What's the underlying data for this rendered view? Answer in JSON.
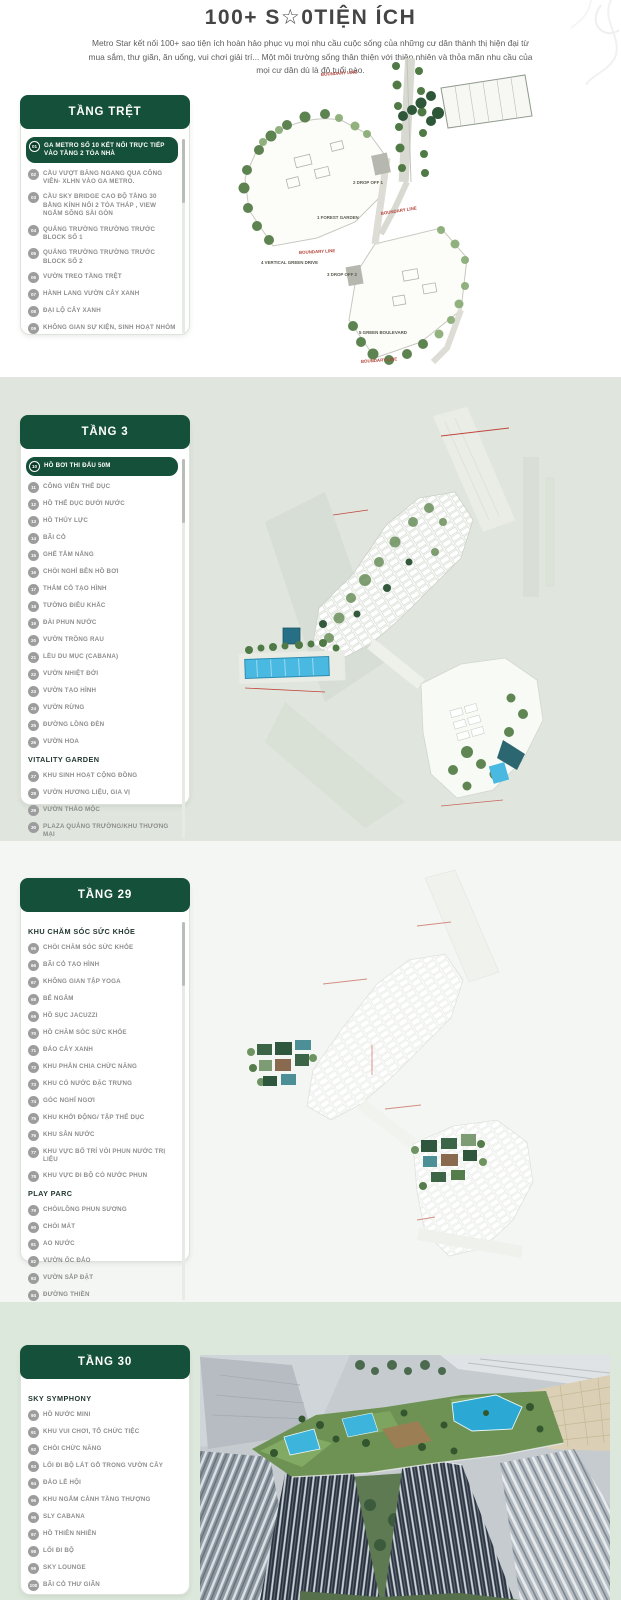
{
  "page": {
    "title": "100+ S☆0TIỆN ÍCH",
    "description": "Metro Star kết nối 100+ sao tiện ích hoàn hảo phục vụ mọi nhu cầu cuộc sống của những cư dân thành thị hiện đại từ mua sắm, thư giãn, ăn uống, vui chơi giải trí... Một môi trường sống thân thiện với thiên nhiên và thỏa mãn nhu cầu của mọi cư dân dù là độ tuổi nào."
  },
  "colors": {
    "card_header_green": "#15503a",
    "highlight_pill_green": "#15503a",
    "band2_bg": "#e0e6de",
    "band3_bg": "#f4f6f3",
    "band4_bg": "#dde8dc",
    "item_gray": "#8d8d8d",
    "pool_blue": "#49b9e2",
    "boundary_red": "#b5443a"
  },
  "sections": [
    {
      "header": "TẦNG TRỆT",
      "groups": [
        {
          "heading": "",
          "items": [
            {
              "num": "01",
              "label": "GA METRO SỐ 10 KẾT NỐI TRỰC TIẾP VÀO TẦNG 2 TÒA NHÀ",
              "highlight": true
            },
            {
              "num": "02",
              "label": "CẦU VƯỢT BĂNG NGANG QUA CÔNG VIÊN- XLHN VÀO GA METRO."
            },
            {
              "num": "03",
              "label": "CẦU SKY BRIDGE CAO ĐỘ TẦNG 30 BẰNG KÍNH NỐI 2 TÒA THÁP , VIEW NGẮM SÔNG SÀI GÒN"
            },
            {
              "num": "04",
              "label": "QUẢNG TRƯỜNG TRƯỜNG TRƯỚC BLOCK SỐ 1"
            },
            {
              "num": "05",
              "label": "QUẢNG TRƯỜNG TRƯỜNG TRƯỚC BLOCK SỐ 2"
            },
            {
              "num": "06",
              "label": "VƯỜN TREO TẦNG TRỆT"
            },
            {
              "num": "07",
              "label": "HÀNH LANG VƯỜN CÂY XANH"
            },
            {
              "num": "08",
              "label": "ĐẠI LỘ CÂY XANH"
            },
            {
              "num": "09",
              "label": "KHÔNG GIAN SỰ KIỆN, SINH HOẠT NHÓM"
            }
          ]
        }
      ]
    },
    {
      "header": "TẦNG 3",
      "groups": [
        {
          "heading": "",
          "items": [
            {
              "num": "10",
              "label": "HỒ BƠI THI ĐẤU 50M",
              "highlight": true
            },
            {
              "num": "11",
              "label": "CÔNG VIÊN THỂ DỤC"
            },
            {
              "num": "12",
              "label": "HỒ THỂ DỤC DƯỚI NƯỚC"
            },
            {
              "num": "13",
              "label": "HỒ THỦY LỰC"
            },
            {
              "num": "14",
              "label": "BÃI CỎ"
            },
            {
              "num": "15",
              "label": "GHẾ TẮM NẮNG"
            },
            {
              "num": "16",
              "label": "CHÒI NGHỈ BÊN HỒ BƠI"
            },
            {
              "num": "17",
              "label": "THẢM CỎ TẠO HÌNH"
            },
            {
              "num": "18",
              "label": "TƯỜNG ĐIÊU KHẮC"
            },
            {
              "num": "19",
              "label": "ĐÀI PHUN NƯỚC"
            },
            {
              "num": "20",
              "label": "VƯỜN TRỒNG RAU"
            },
            {
              "num": "21",
              "label": "LỀU DU MỤC (CABANA)"
            },
            {
              "num": "22",
              "label": "VƯỜN NHIỆT ĐỚI"
            },
            {
              "num": "23",
              "label": "VƯỜN TẠO HÌNH"
            },
            {
              "num": "24",
              "label": "VƯỜN RỪNG"
            },
            {
              "num": "25",
              "label": "ĐƯỜNG LỒNG ĐÈN"
            },
            {
              "num": "26",
              "label": "VƯỜN HOA"
            }
          ]
        },
        {
          "heading": "VITALITY GARDEN",
          "items": [
            {
              "num": "27",
              "label": "KHU SINH HOẠT CỘNG ĐỒNG"
            },
            {
              "num": "28",
              "label": "VƯỜN HƯƠNG LIỆU, GIA VỊ"
            },
            {
              "num": "29",
              "label": "VƯỜN THẢO MỘC"
            },
            {
              "num": "30",
              "label": "PLAZA QUẢNG TRƯỜNG/KHU THƯƠNG MẠI"
            }
          ]
        }
      ]
    },
    {
      "header": "TẦNG 29",
      "groups": [
        {
          "heading": "KHU CHĂM SÓC SỨC KHỎE",
          "items": [
            {
              "num": "65",
              "label": "CHÒI CHĂM SÓC SỨC KHỎE"
            },
            {
              "num": "66",
              "label": "BÃI CỎ TẠO HÌNH"
            },
            {
              "num": "67",
              "label": "KHÔNG GIAN TẬP YOGA"
            },
            {
              "num": "68",
              "label": "BỂ NGÂM"
            },
            {
              "num": "69",
              "label": "HỒ SỤC JACUZZI"
            },
            {
              "num": "70",
              "label": "HỒ CHĂM SÓC SỨC KHỎE"
            },
            {
              "num": "71",
              "label": "ĐẢO CÂY XANH"
            },
            {
              "num": "72",
              "label": "KHU PHÂN CHIA CHỨC NĂNG"
            },
            {
              "num": "73",
              "label": "KHU CÓ NƯỚC ĐẶC TRƯNG"
            },
            {
              "num": "74",
              "label": "GÓC NGHỈ NGƠI"
            },
            {
              "num": "75",
              "label": "KHU KHỞI ĐỘNG/ TẬP THỂ DỤC"
            },
            {
              "num": "76",
              "label": "KHU SÂN NƯỚC"
            },
            {
              "num": "77",
              "label": "KHU VỰC BỐ TRÍ VÒI PHUN NƯỚC TRỊ LIỆU"
            },
            {
              "num": "78",
              "label": "KHU VỰC ĐI BỘ CÓ NƯỚC PHUN"
            }
          ]
        },
        {
          "heading": "PLAY PARC",
          "items": [
            {
              "num": "79",
              "label": "CHÒI/LỒNG PHUN SƯƠNG"
            },
            {
              "num": "80",
              "label": "CHÒI MÁT"
            },
            {
              "num": "81",
              "label": "AO NƯỚC"
            },
            {
              "num": "82",
              "label": "VƯỜN ỐC ĐẢO"
            },
            {
              "num": "83",
              "label": "VƯỜN SẮP ĐẶT"
            },
            {
              "num": "84",
              "label": "ĐƯỜNG THIỀN"
            }
          ]
        }
      ]
    },
    {
      "header": "TẦNG 30",
      "groups": [
        {
          "heading": "SKY SYMPHONY",
          "items": [
            {
              "num": "90",
              "label": "HỒ NƯỚC MINI"
            },
            {
              "num": "91",
              "label": "KHU VUI CHƠI, TỔ CHỨC TIỆC"
            },
            {
              "num": "92",
              "label": "CHÒI CHỨC NĂNG"
            },
            {
              "num": "93",
              "label": "LỐI ĐI BỘ LÁT GỖ TRONG VƯỜN CÂY"
            },
            {
              "num": "94",
              "label": "ĐẢO LỄ HỘI"
            },
            {
              "num": "95",
              "label": "KHU NGẮM CẢNH TẦNG THƯỢNG"
            },
            {
              "num": "96",
              "label": "SLY CABANA"
            },
            {
              "num": "97",
              "label": "HỒ THIÊN NHIÊN"
            },
            {
              "num": "98",
              "label": "LỐI ĐI BỘ"
            },
            {
              "num": "99",
              "label": "SKY LOUNGE"
            },
            {
              "num": "100",
              "label": "BÃI CỎ THƯ GIÃN"
            }
          ]
        }
      ]
    }
  ],
  "plan1_labels": {
    "boundary_top": "BOUNDARY LINE",
    "drop_off_1": "2 DROP OFF 1",
    "boundary_mid": "BOUNDARY LINE",
    "forest_garden": "1 FOREST GARDEN",
    "boundary_low": "BOUNDARY LINE",
    "drop_off_2": "3 DROP OFF 2",
    "vertical_green_drive": "4 VERTICAL GREEN DRIVE",
    "green_boulevard": "5 GREEN BOULEVARD",
    "boundary_bottom": "BOUNDARY LINE"
  }
}
